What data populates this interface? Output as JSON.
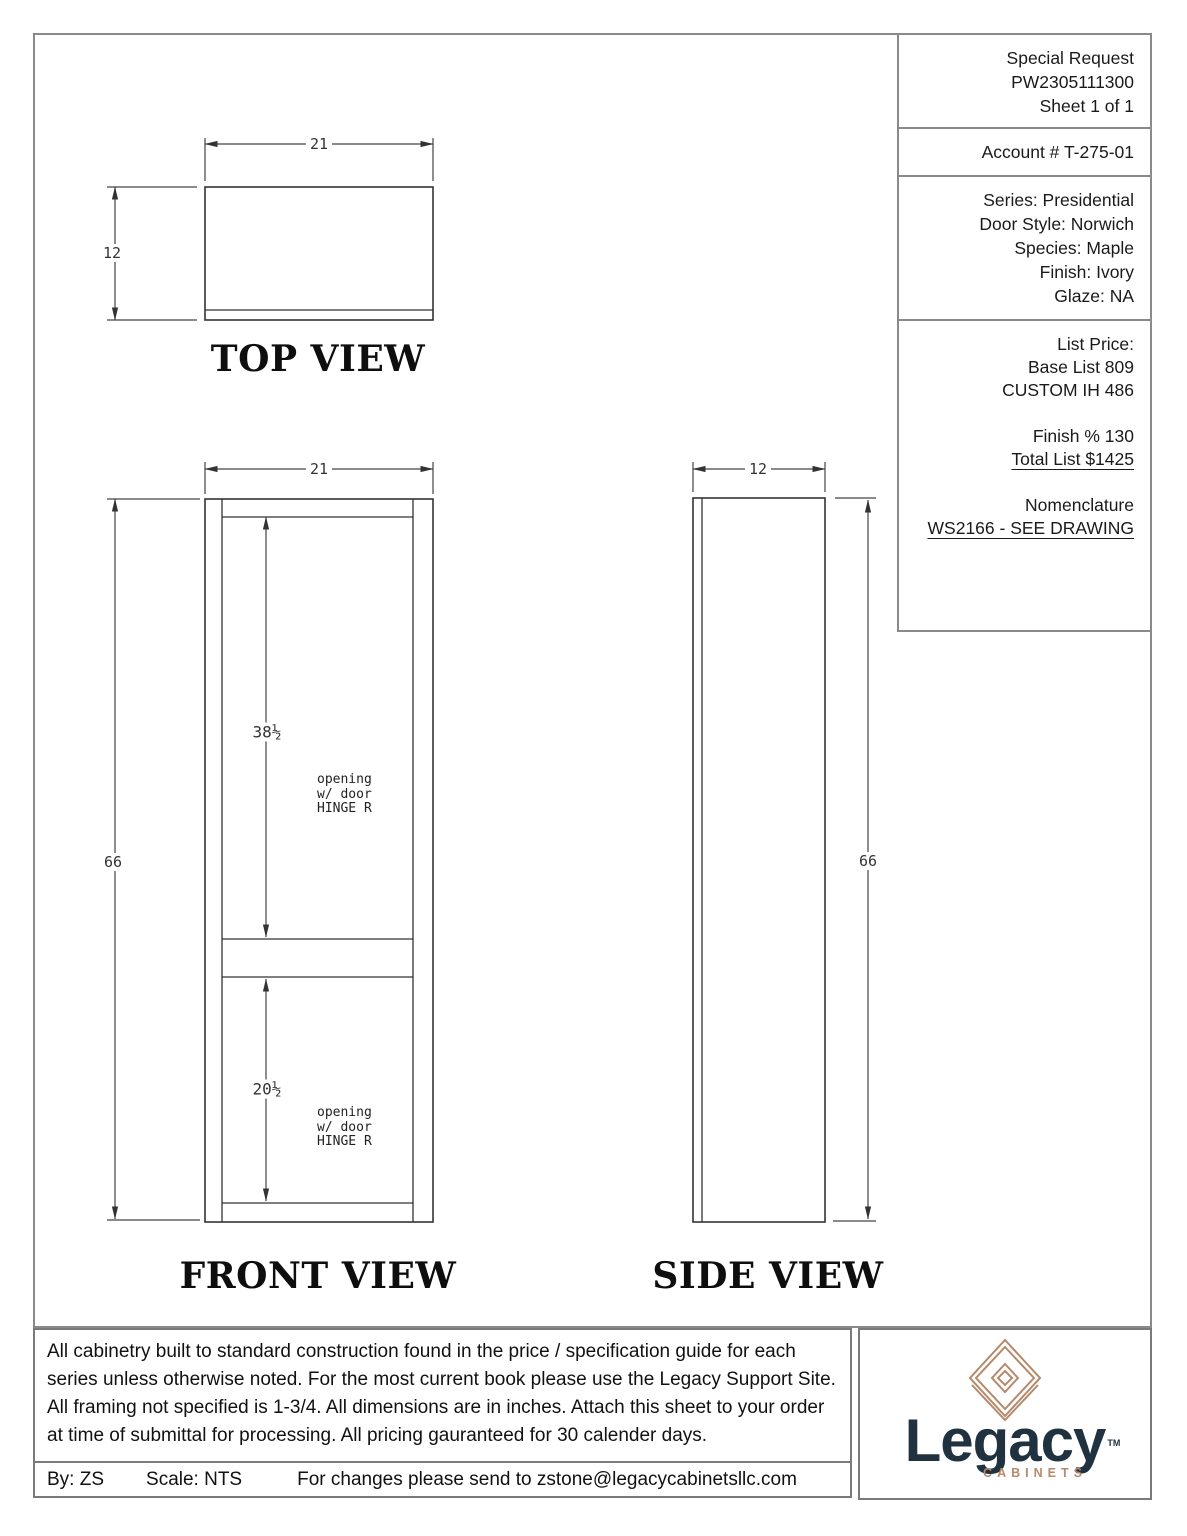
{
  "sheet": {
    "views": {
      "top_label": "TOP VIEW",
      "front_label": "FRONT VIEW",
      "side_label": "SIDE VIEW"
    },
    "dims": {
      "width": "21",
      "depth": "12",
      "height": "66",
      "upper_opening": "38½",
      "lower_opening": "20½"
    },
    "opening_note": {
      "line1": "opening",
      "line2": "w/ door",
      "line3": "HINGE R"
    }
  },
  "title_block": {
    "request_type": "Special Request",
    "order_number": "PW2305111300",
    "sheet_count": "Sheet 1 of 1",
    "account": "Account # T-275-01",
    "series": "Series: Presidential",
    "door_style": "Door Style: Norwich",
    "species": "Species: Maple",
    "finish": "Finish: Ivory",
    "glaze": "Glaze: NA",
    "list_price_label": "List Price:",
    "base_list": "Base List 809",
    "custom_line": "CUSTOM IH 486",
    "finish_pct": "Finish % 130",
    "total_list": "Total List $1425",
    "nomenclature_label": "Nomenclature",
    "nomenclature_value": "WS2166 - SEE DRAWING"
  },
  "footer": {
    "disclaimer": "All cabinetry built to standard construction found in the price / specification guide for each series unless otherwise noted. For the most current book please use the Legacy Support Site. All framing not specified is 1-3/4. All dimensions are in inches. Attach this sheet to your order at time of submittal for processing. All pricing gauranteed for 30 calender days.",
    "by": "By: ZS",
    "scale": "Scale: NTS",
    "changes": "For changes please send to zstone@legacycabinetsllc.com"
  },
  "logo": {
    "word": "Legacy",
    "tm": "TM",
    "sub": "CABINETS",
    "navy": "#20323f",
    "copper": "#b6896a"
  }
}
